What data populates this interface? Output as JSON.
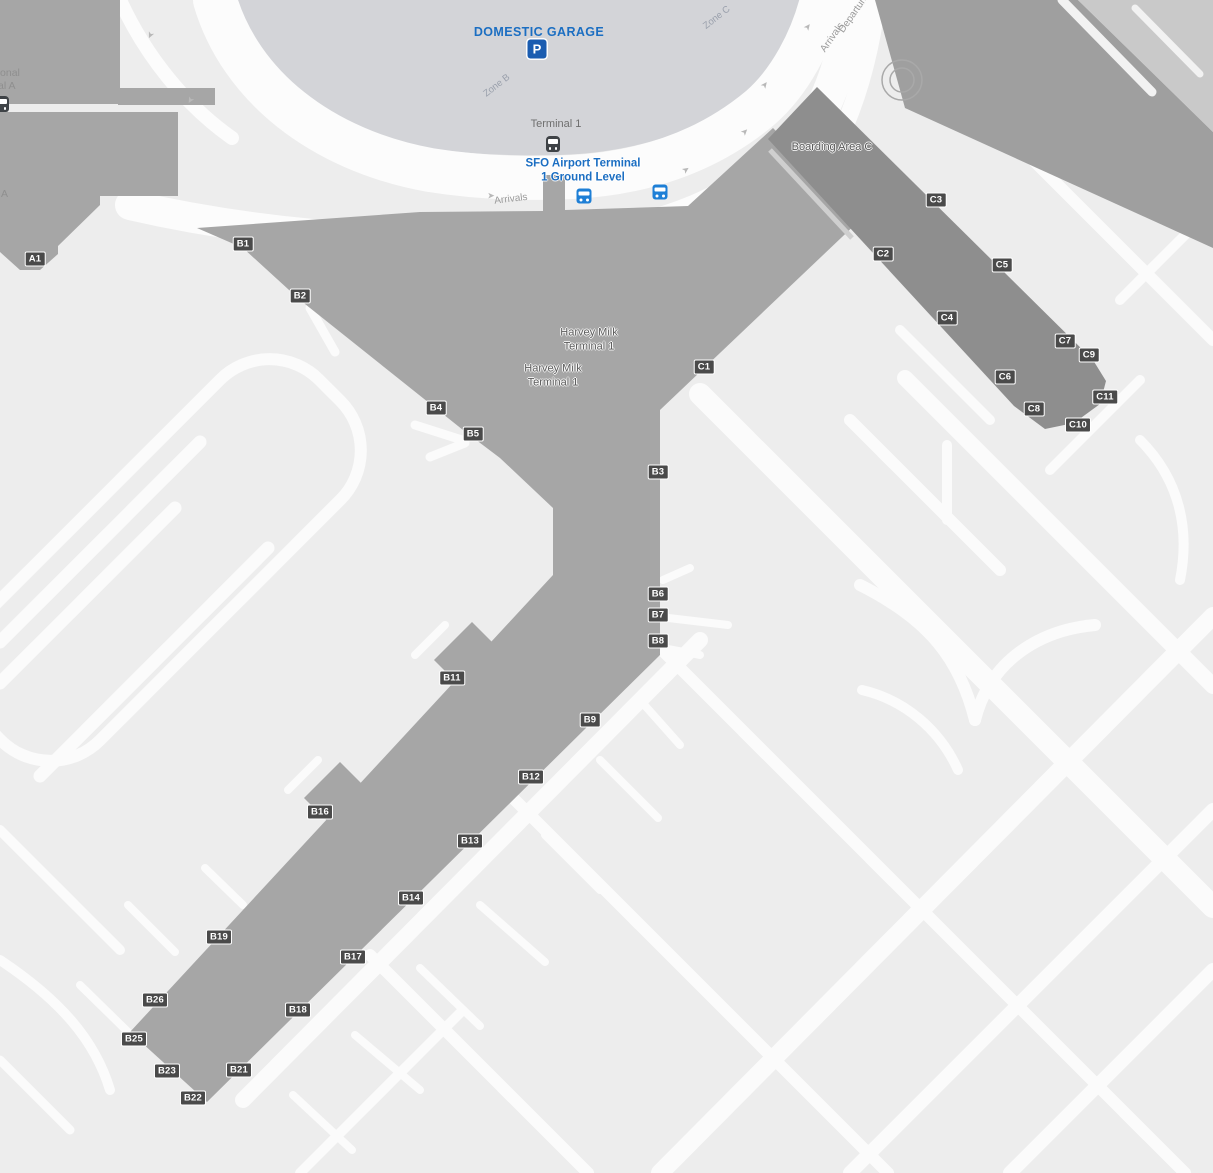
{
  "map_title": "SFO Harvey Milk Terminal 1 — Ground Level map",
  "colors": {
    "apron": "#ededed",
    "road_white": "#fcfcfc",
    "terminal_building": "#a6a6a6",
    "boarding_pier_c": "#8e8e8e",
    "garage_area": "#d3d4d8",
    "gate_badge_bg": "#4a4a4a",
    "brand_blue_text": "#1b6ec2",
    "bus_marker_blue": "#1e7fd6",
    "parking_marker_blue": "#1a5cb0"
  },
  "labels": {
    "domestic_garage": "DOMESTIC GARAGE",
    "zone_b": "Zone B",
    "zone_c": "Zone C",
    "terminal_1_station": "Terminal 1",
    "ground_level_line1": "SFO Airport Terminal",
    "ground_level_line2": "1 Ground Level",
    "arrivals_lower": "Arrivals",
    "arrivals_upper": "Arrivals",
    "departures": "Departures",
    "harvey_milk_line1": "Harvey Milk",
    "harvey_milk_line2": "Terminal 1",
    "boarding_area_c": "Boarding Area C",
    "intl_terminal_line1": "International",
    "intl_terminal_line2": "Terminal A",
    "boarding_area_a_line1": "International",
    "boarding_area_a_line2": "Boarding Area A"
  },
  "gates": [
    {
      "id": "A1",
      "x": 35,
      "y": 259
    },
    {
      "id": "B1",
      "x": 243,
      "y": 244
    },
    {
      "id": "B2",
      "x": 300,
      "y": 296
    },
    {
      "id": "B3",
      "x": 658,
      "y": 472
    },
    {
      "id": "B4",
      "x": 436,
      "y": 408
    },
    {
      "id": "B5",
      "x": 473,
      "y": 434
    },
    {
      "id": "B6",
      "x": 658,
      "y": 594
    },
    {
      "id": "B7",
      "x": 658,
      "y": 615
    },
    {
      "id": "B8",
      "x": 658,
      "y": 641
    },
    {
      "id": "B9",
      "x": 590,
      "y": 720
    },
    {
      "id": "B11",
      "x": 452,
      "y": 678
    },
    {
      "id": "B12",
      "x": 531,
      "y": 777
    },
    {
      "id": "B13",
      "x": 470,
      "y": 841
    },
    {
      "id": "B14",
      "x": 411,
      "y": 898
    },
    {
      "id": "B16",
      "x": 320,
      "y": 812
    },
    {
      "id": "B17",
      "x": 353,
      "y": 957
    },
    {
      "id": "B18",
      "x": 298,
      "y": 1010
    },
    {
      "id": "B19",
      "x": 219,
      "y": 937
    },
    {
      "id": "B21",
      "x": 239,
      "y": 1070
    },
    {
      "id": "B22",
      "x": 193,
      "y": 1098
    },
    {
      "id": "B23",
      "x": 167,
      "y": 1071
    },
    {
      "id": "B25",
      "x": 134,
      "y": 1039
    },
    {
      "id": "B26",
      "x": 155,
      "y": 1000
    },
    {
      "id": "C1",
      "x": 704,
      "y": 367
    },
    {
      "id": "C2",
      "x": 883,
      "y": 254
    },
    {
      "id": "C3",
      "x": 936,
      "y": 200
    },
    {
      "id": "C4",
      "x": 947,
      "y": 318
    },
    {
      "id": "C5",
      "x": 1002,
      "y": 265
    },
    {
      "id": "C6",
      "x": 1005,
      "y": 377
    },
    {
      "id": "C7",
      "x": 1065,
      "y": 341
    },
    {
      "id": "C8",
      "x": 1034,
      "y": 409
    },
    {
      "id": "C9",
      "x": 1089,
      "y": 355
    },
    {
      "id": "C10",
      "x": 1078,
      "y": 425
    },
    {
      "id": "C11",
      "x": 1105,
      "y": 397
    }
  ]
}
